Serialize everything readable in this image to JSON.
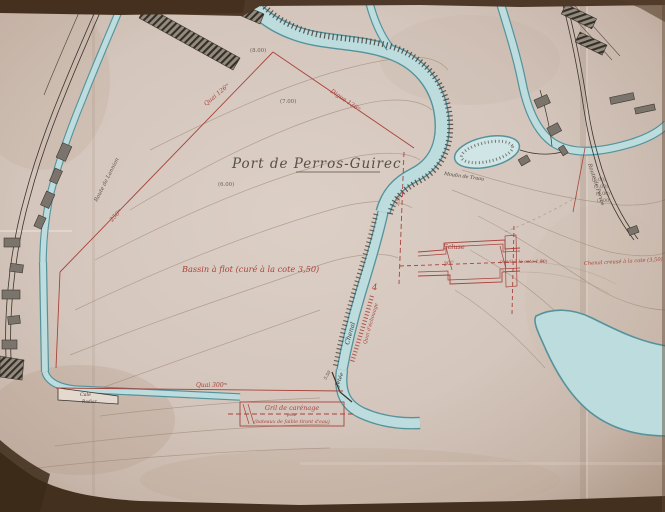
{
  "map": {
    "title": "Port de Perros-Guirec",
    "labels": {
      "basin": "Bassin à flot (curé à la cote 3,50)",
      "ecluse": "Écluse",
      "seuil": "(seuil à la cote 1,50)",
      "chenal_creuse": "Chenal creusé à la cote (3,50)",
      "gril_1": "Gril de carénage",
      "gril_2": "pour",
      "gril_3": "(bateaux de faible tirant d'eau)",
      "chenal": "Chenal",
      "jetee": "Jetée",
      "cale": "Cale",
      "radier": "Radier",
      "pond": "Moulin de Traou",
      "route_left": "Route de Lannion",
      "route_right": "Route de Perros",
      "quai_channel": "Quai d'échouage"
    },
    "dimensions": {
      "d_quai126": "Quai 126ᵐ",
      "d_digue136": "Digue 136ᵐ",
      "d_quai300": "Quai 300ᵐ",
      "d_250": "250ᵐ",
      "d_30": "30ᵐ",
      "d_4": "4",
      "d_550": "5.50",
      "d_250b": "2.50"
    },
    "contours": {
      "c8": "(8.00)",
      "c7": "(7.00)",
      "c6": "(6.00)",
      "r6": "(6.00)",
      "r5": "(5.00)",
      "r4": "(4.00)",
      "r3": "(3.00)"
    },
    "colors": {
      "paper": "#d5c7bd",
      "water": "#bcdcde",
      "water_edge": "#55929b",
      "ink_red": "#a8433c",
      "ink_black": "#3a332c",
      "contour": "#97826f"
    }
  }
}
